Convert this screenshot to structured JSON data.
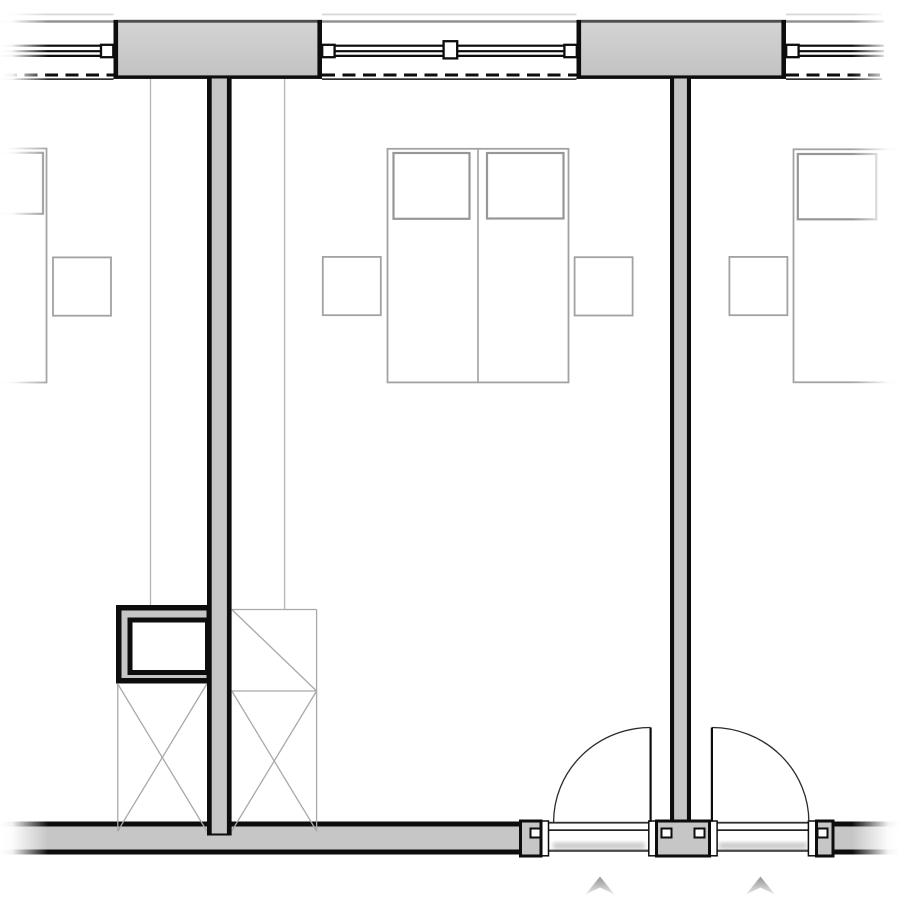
{
  "page": {
    "description": "Black-and-white architectural floor plan crop: three hotel guest rooms with a window wall at top, beds with pillows, nightstands, wardrobes with X symbols, a duct shaft, and entry doors with quarter-circle swing arcs at bottom",
    "visible_text": []
  },
  "inventory": {
    "windows": 3,
    "window_mullions": 5,
    "window_piers": 2,
    "partition_walls": 2,
    "double_beds": 1,
    "single_beds_partial": 2,
    "pillows": 4,
    "nightstands": 4,
    "wardrobe_units": 2,
    "duct_shaft": 1,
    "entry_doors": 2,
    "door_swing_arcs": 2,
    "entry_arrows": 2
  },
  "colors": {
    "background": "#ffffff",
    "wall_fill": "#c6c6c6",
    "pier_light": "#d5d5d5",
    "pier_dark": "#c1c1c1",
    "pier_top": "#4f4f4f",
    "line_black": "#0d0d0d",
    "line_dark": "#2e2e2e",
    "top_line": "#8f8f8f",
    "faint_line": "#d8d8d8",
    "furniture_line": "#a2a2a2",
    "pillow_line": "#979797",
    "wardrobe_line": "#a9a9a9",
    "ref_line": "#b5b5b5",
    "door_arc": "#2b2b2b",
    "arrow_top": "#a0a0a0",
    "arrow_bottom": "#e9e9e9"
  }
}
